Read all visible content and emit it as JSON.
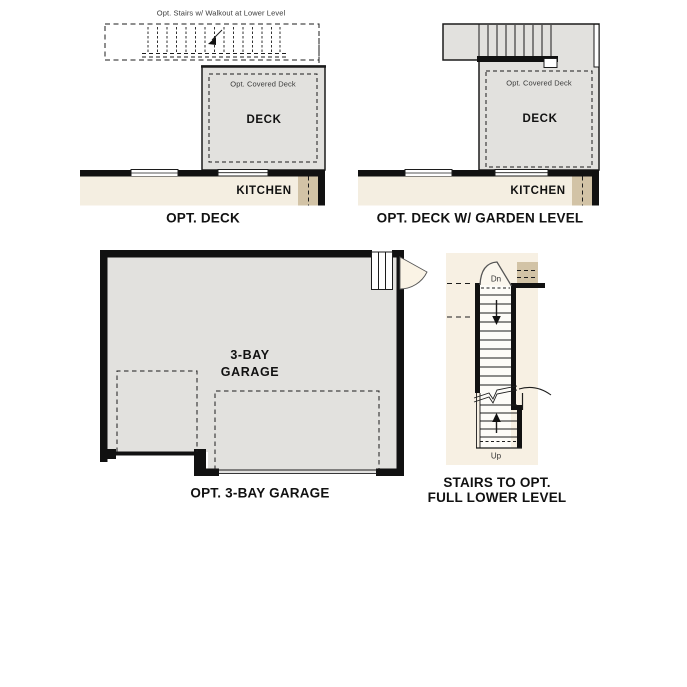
{
  "colors": {
    "wall": "#111111",
    "line": "#1c1c1c",
    "deck_fill": "#e2e1de",
    "kitchen_fill": "#f4eee1",
    "tan_accent": "#d2c3a6",
    "stairs_bg": "#f7f0e3",
    "door_fan": "#faf3e5"
  },
  "panels": {
    "opt_deck": {
      "caption": "OPT. DECK",
      "stairs_note": "Opt. Stairs w/ Walkout at Lower Level",
      "covered_deck_label": "Opt. Covered Deck",
      "deck_label": "DECK",
      "kitchen_label": "KITCHEN"
    },
    "opt_deck_garden": {
      "caption": "OPT. DECK W/ GARDEN LEVEL",
      "covered_deck_label": "Opt. Covered Deck",
      "deck_label": "DECK",
      "kitchen_label": "KITCHEN"
    },
    "garage": {
      "caption": "OPT. 3-BAY GARAGE",
      "room_label_line1": "3-BAY",
      "room_label_line2": "GARAGE"
    },
    "stairs": {
      "caption_line1": "STAIRS TO OPT.",
      "caption_line2": "FULL LOWER LEVEL",
      "down_label": "Dn",
      "up_label": "Up"
    }
  }
}
